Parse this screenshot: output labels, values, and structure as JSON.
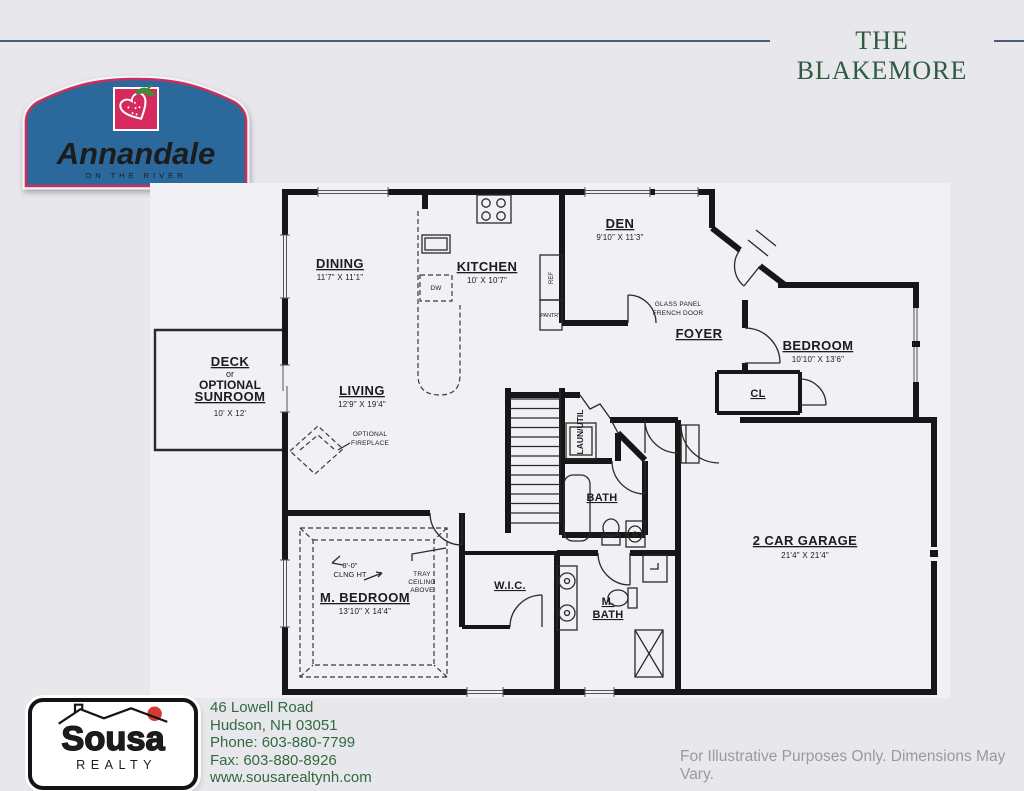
{
  "page": {
    "title": "THE BLAKEMORE",
    "disclaimer": "For Illustrative Purposes Only. Dimensions May Vary.",
    "background": "#e8e7ec",
    "accent_line_color": "#4d5a78",
    "title_color": "#2d5c40"
  },
  "community": {
    "name": "Annandale",
    "tagline": "ON THE RIVER",
    "plaque_blue": "#2b689c",
    "plaque_red_border": "#c5305c",
    "berry_red": "#d62a5e",
    "leaf_green": "#3f8f33"
  },
  "realtor": {
    "name": "Sousa",
    "label": "REALTY",
    "address1": "46 Lowell Road",
    "address2": "Hudson, NH 03051",
    "phone": "Phone: 603-880-7799",
    "fax": "Fax: 603-880-8926",
    "website": "www.sousarealtynh.com",
    "text_green": "#2f6b3f",
    "brand_blue": "#4156a6",
    "sun_red": "#d23b2f"
  },
  "floorplan": {
    "rooms": {
      "dining": {
        "label": "DINING",
        "dims": "11'7\" X 11'1\""
      },
      "kitchen": {
        "label": "KITCHEN",
        "dims": "10' X 10'7\""
      },
      "den": {
        "label": "DEN",
        "dims": "9'10\" X 11'3\""
      },
      "foyer": {
        "label": "FOYER"
      },
      "bedroom": {
        "label": "BEDROOM",
        "dims": "10'10\" X 13'6\""
      },
      "living": {
        "label": "LIVING",
        "dims": "12'9\" X 19'4\""
      },
      "deck": {
        "line1": "DECK",
        "line2": "or",
        "line3": "OPTIONAL",
        "line4": "SUNROOM",
        "dims": "10' X 12'"
      },
      "master_bedroom": {
        "label": "M. BEDROOM",
        "dims": "13'10\" X 14'4\""
      },
      "wic": {
        "label": "W.I.C."
      },
      "bath": {
        "label": "BATH"
      },
      "master_bath": {
        "line1": "M.",
        "line2": "BATH"
      },
      "garage": {
        "label": "2 CAR GARAGE",
        "dims": "21'4\" X 21'4\""
      },
      "closet": {
        "label": "CL"
      },
      "laundry": {
        "label": "LAUN/UTIL"
      }
    },
    "annotations": {
      "french_door_line1": "GLASS PANEL",
      "french_door_line2": "FRENCH DOOR",
      "fireplace_line1": "OPTIONAL",
      "fireplace_line2": "FIREPLACE",
      "ceiling_height": "8'-0\"",
      "ceiling_height_label": "CLNG HT",
      "tray_line1": "TRAY",
      "tray_line2": "CEILING",
      "tray_line3": "ABOVE",
      "dishwasher": "DW",
      "refrigerator": "REF",
      "pantry": "PANTRY"
    }
  }
}
